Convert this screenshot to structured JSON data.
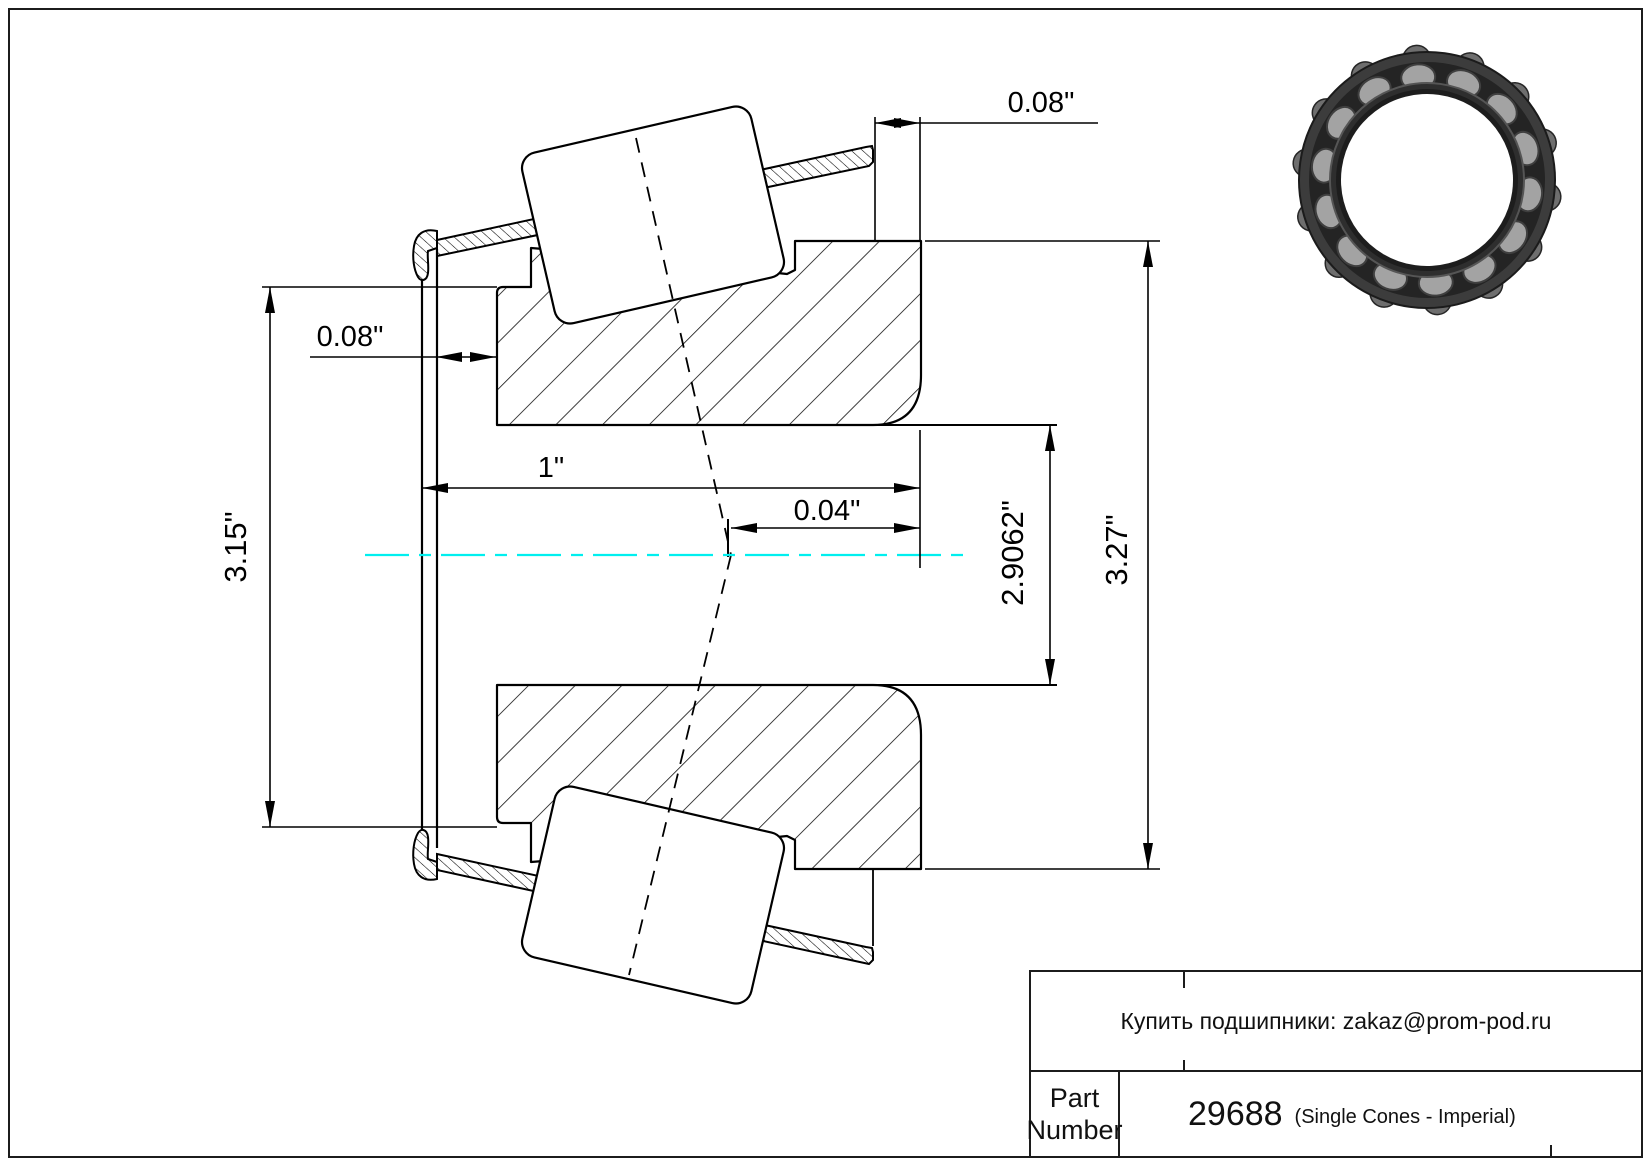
{
  "sheet": {
    "dimensions": {
      "cage_protrusion_top": "0.08\"",
      "cage_protrusion_left": "0.08\"",
      "cone_width": "1\"",
      "effective_center_offset": "0.04\"",
      "bore_diameter": "2.9062\"",
      "outside_diameter": "3.27\"",
      "cage_flange_diameter": "3.15\""
    },
    "colors": {
      "centerline": "#00efef",
      "line": "#000000"
    },
    "photo": "tapered-roller-bearing-photo"
  },
  "title_block": {
    "contact": "Купить подшипники: zakaz@prom-pod.ru",
    "part_label": "Part Number",
    "part_number": "29688",
    "part_series": "(Single Cones - Imperial)"
  }
}
